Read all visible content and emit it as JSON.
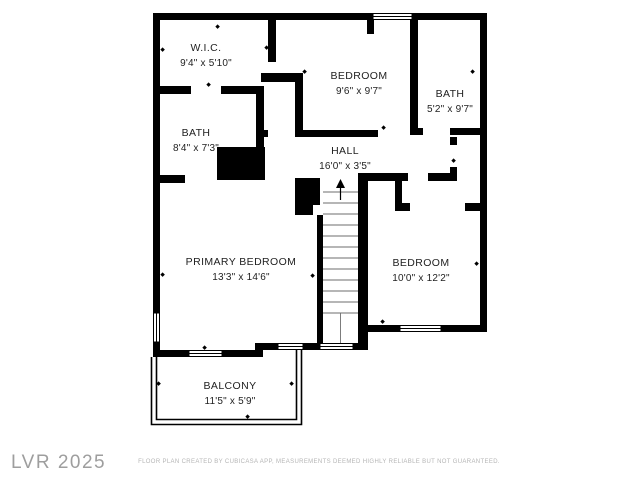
{
  "plan": {
    "rooms": [
      {
        "id": "wic",
        "name": "W.I.C.",
        "dims": "9'4\" x 5'10\""
      },
      {
        "id": "bedroom-top",
        "name": "BEDROOM",
        "dims": "9'6\" x 9'7\""
      },
      {
        "id": "bath-right",
        "name": "BATH",
        "dims": "5'2\" x 9'7\""
      },
      {
        "id": "bath-left",
        "name": "BATH",
        "dims": "8'4\" x 7'3\""
      },
      {
        "id": "hall",
        "name": "HALL",
        "dims": "16'0\" x 3'5\""
      },
      {
        "id": "primary-bedroom",
        "name": "PRIMARY BEDROOM",
        "dims": "13'3\" x 14'6\""
      },
      {
        "id": "bedroom-right",
        "name": "BEDROOM",
        "dims": "10'0\" x 12'2\""
      },
      {
        "id": "balcony",
        "name": "BALCONY",
        "dims": "11'5\" x 5'9\""
      }
    ],
    "stairs": {
      "direction": "up",
      "icon": "up-arrow"
    }
  },
  "watermark": {
    "text": "LVR 2025"
  },
  "footer": {
    "disclaimer": "FLOOR PLAN CREATED BY CUBICASA APP, MEASUREMENTS DEEMED HIGHLY RELIABLE BUT NOT GUARANTEED."
  },
  "colors": {
    "wall": "#000000",
    "background": "#ffffff",
    "label": "#1f1f1f",
    "watermark": "#9e9e9e",
    "disclaimer": "#b5b5b5"
  }
}
